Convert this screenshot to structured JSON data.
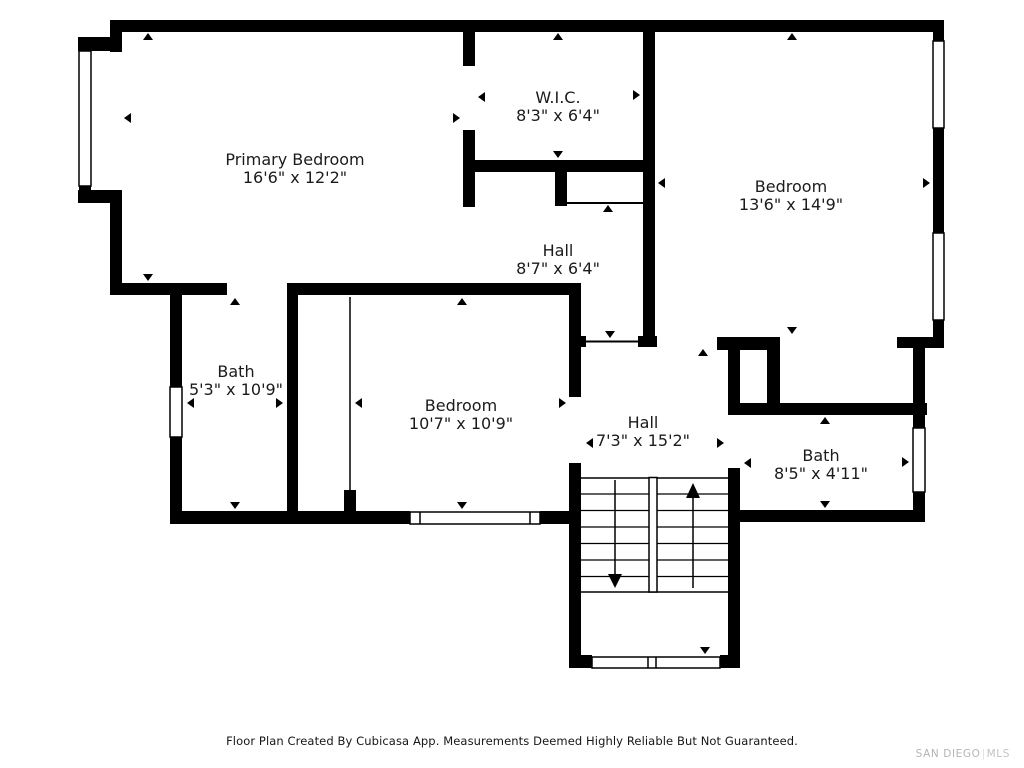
{
  "plan": {
    "wall_color": "#000000",
    "background": "#ffffff",
    "text_color": "#1b1b1b"
  },
  "rooms": [
    {
      "id": "primary-bedroom",
      "name": "Primary Bedroom",
      "dims": "16'6\" x 12'2\""
    },
    {
      "id": "wic",
      "name": "W.I.C.",
      "dims": "8'3\" x 6'4\""
    },
    {
      "id": "bedroom-right",
      "name": "Bedroom",
      "dims": "13'6\" x 14'9\""
    },
    {
      "id": "hall-upper",
      "name": "Hall",
      "dims": "8'7\" x 6'4\""
    },
    {
      "id": "bath-left",
      "name": "Bath",
      "dims": "5'3\" x 10'9\""
    },
    {
      "id": "bedroom-center",
      "name": "Bedroom",
      "dims": "10'7\" x 10'9\""
    },
    {
      "id": "hall-lower",
      "name": "Hall",
      "dims": "7'3\" x 15'2\""
    },
    {
      "id": "bath-right",
      "name": "Bath",
      "dims": "8'5\" x 4'11\""
    }
  ],
  "footer": {
    "disclaimer": "Floor Plan Created By Cubicasa App. Measurements Deemed Highly Reliable But Not Guaranteed."
  },
  "watermark": {
    "primary": "SAN DIEGO",
    "separator": "|",
    "secondary": "MLS"
  }
}
